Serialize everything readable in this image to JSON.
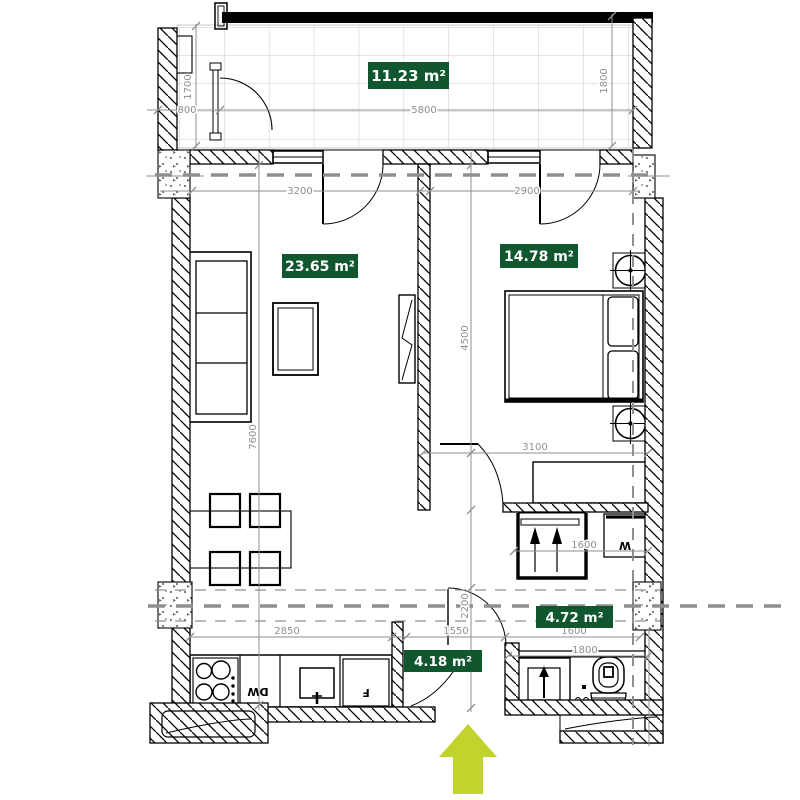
{
  "rooms": {
    "balcony": {
      "area": "11.23 m²"
    },
    "living": {
      "area": "23.65 m²"
    },
    "bedroom": {
      "area": "14.78 m²"
    },
    "hallway": {
      "area": "4.72 m²"
    },
    "kitchen": {
      "area": "4.18 m²"
    }
  },
  "dims": {
    "d800": "800",
    "d1700": "1700",
    "d5800": "5800",
    "d1800_balcony": "1800",
    "d3200": "3200",
    "d2900": "2900",
    "d7600": "7600",
    "d4500": "4500",
    "d3100": "3100",
    "d1600_closet": "1600",
    "d2850": "2850",
    "d1550": "1550",
    "d2200": "2200",
    "d1600_bath": "1600",
    "d1800_bath": "1800"
  },
  "appliances": {
    "dishwasher": "DW",
    "fridge": "F",
    "washer": "W"
  },
  "icons": {
    "entrance": "entrance-arrow-icon",
    "hanger": "hanger-icon",
    "shower_arrow": "arrow-up-icon"
  },
  "colors": {
    "label_bg": "#10562e",
    "label_text": "#ffffff",
    "entrance_arrow": "#c1d32d",
    "dim_gray": "#8f8f8f"
  }
}
